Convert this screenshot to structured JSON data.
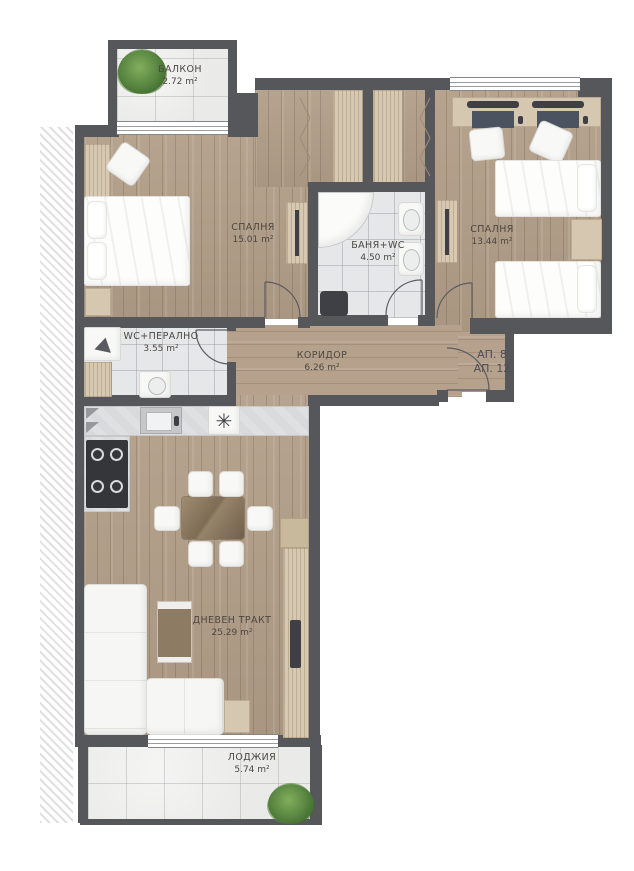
{
  "plan": {
    "rooms": {
      "balcony": {
        "name": "БАЛКОН",
        "area": "2.72 m²"
      },
      "bedroom1": {
        "name": "СПАЛНЯ",
        "area": "15.01 m²"
      },
      "bathroom": {
        "name": "БАНЯ+WC",
        "area": "4.50 m²"
      },
      "bedroom2": {
        "name": "СПАЛНЯ",
        "area": "13.44 m²"
      },
      "wc_laundry": {
        "name": "WC+ПЕРАЛНО",
        "area": "3.55 m²"
      },
      "corridor": {
        "name": "КОРИДОР",
        "area": "6.26 m²"
      },
      "living": {
        "name": "ДНЕВЕН ТРАКТ",
        "area": "25.29 m²"
      },
      "loggia": {
        "name": "ЛОДЖИЯ",
        "area": "5.74 m²"
      }
    },
    "entrance_labels": {
      "line1": "АП. 8",
      "line2": "АП. 12"
    },
    "icons": {
      "vent_fan": "✳"
    },
    "colors": {
      "wall": "#56575b",
      "wood_floor": "#b5a28d",
      "tile_floor": "#e5e6e8",
      "furniture_tan": "#d4c6af",
      "furniture_white": "#f8f8f6",
      "plant_green": "#5d8a44"
    }
  }
}
